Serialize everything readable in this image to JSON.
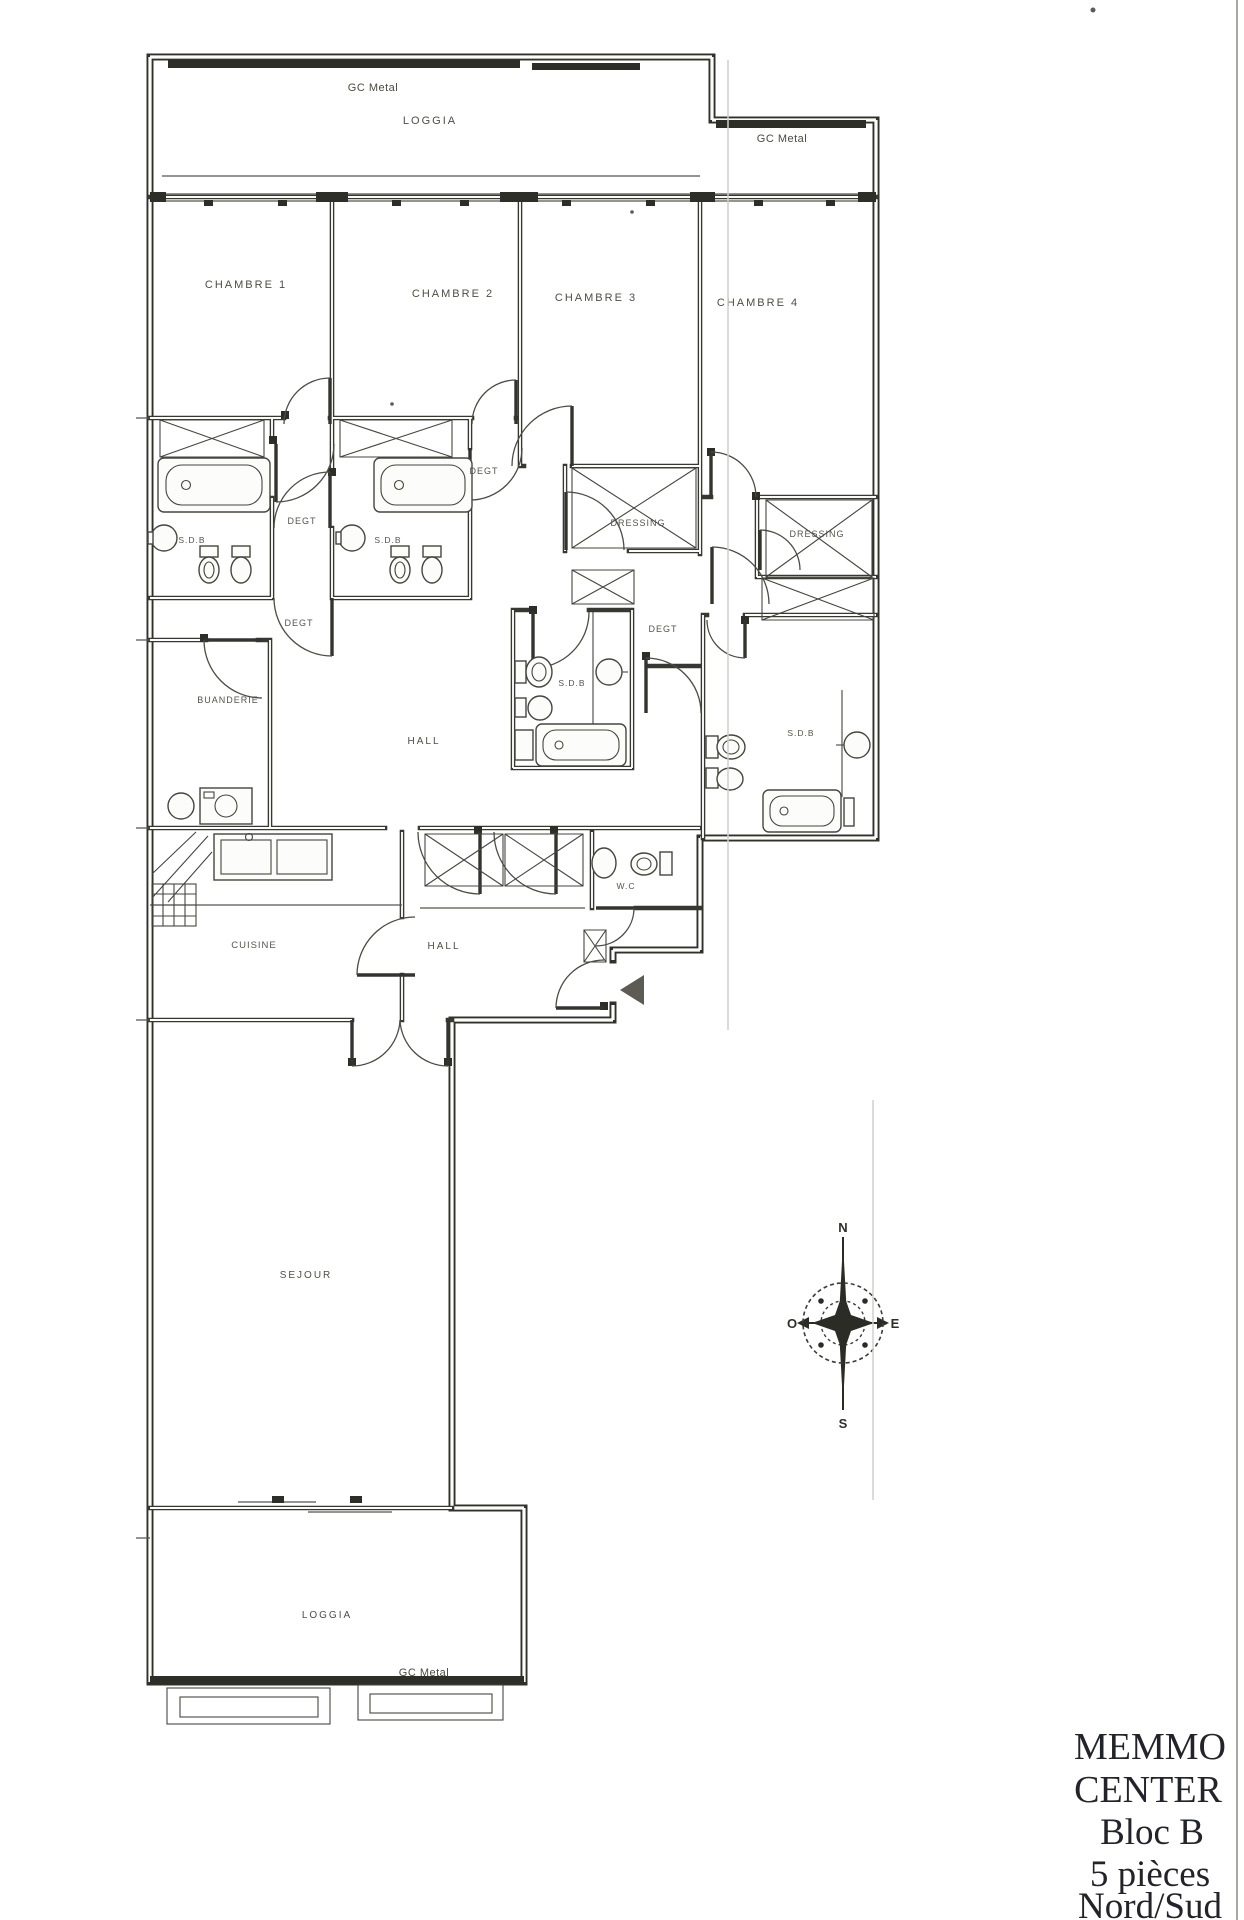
{
  "page": {
    "paper_color": "#fcfcfa",
    "ink_color": "#31312c",
    "label_color": "#4f4d45"
  },
  "plan_labels": {
    "gc_metal_top": "GC Metal",
    "loggia_top": "LOGGIA",
    "gc_metal_upper_right": "GC Metal",
    "chambre_1": "CHAMBRE 1",
    "chambre_2": "CHAMBRE 2",
    "chambre_3": "CHAMBRE 3",
    "chambre_4": "CHAMBRE 4",
    "degt_upper_left": "DEGT",
    "degt_upper_mid": "DEGT",
    "sdb_1": "S.D.B",
    "sdb_2": "S.D.B",
    "dressing_1": "DRESSING",
    "dressing_2": "DRESSING",
    "degt_lower_left": "DEGT",
    "degt_lower_right": "DEGT",
    "sdb_central": "S.D.B",
    "sdb_right": "S.D.B",
    "buanderie": "BUANDERIE",
    "hall_upper": "HALL",
    "hall_lower": "HALL",
    "wc": "W.C",
    "cuisine": "CUISINE",
    "sejour": "SEJOUR",
    "loggia_bottom": "LOGGIA",
    "gc_metal_bottom": "GC Metal"
  },
  "compass": {
    "north": "N",
    "east": "E",
    "south": "S",
    "west": "O"
  },
  "title_block": {
    "line1": "MEMMO",
    "line2": "CENTER",
    "line3": "Bloc B",
    "line4": "5 pièces",
    "line5": "Nord/Sud"
  }
}
